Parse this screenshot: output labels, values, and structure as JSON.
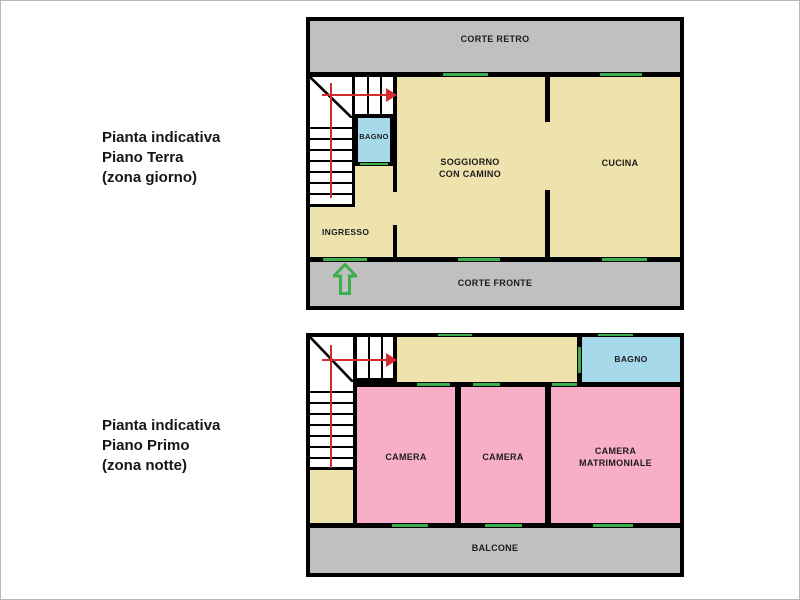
{
  "captions": {
    "ground": {
      "l1": "Pianta indicativa",
      "l2": "Piano Terra",
      "l3": "(zona giorno)"
    },
    "first": {
      "l1": "Pianta indicativa",
      "l2": "Piano Primo",
      "l3": "(zona notte)"
    }
  },
  "ground": {
    "corte_retro": "CORTE RETRO",
    "bagno": "BAGNO",
    "soggiorno1": "SOGGIORNO",
    "soggiorno2": "CON CAMINO",
    "cucina": "CUCINA",
    "ingresso": "INGRESSO",
    "corte_fronte": "CORTE FRONTE"
  },
  "first": {
    "bagno": "BAGNO",
    "camera1": "CAMERA",
    "camera2": "CAMERA",
    "matrimoniale1": "CAMERA",
    "matrimoniale2": "MATRIMONIALE",
    "balcone": "BALCONE"
  },
  "icons": {
    "entrance_arrow": "green-up-arrow-outline",
    "stairs_arrow_ground": "red-right-arrow",
    "stairs_arrow_first": "red-right-arrow"
  },
  "colors": {
    "wall": "#000000",
    "room_beige": "#EEE3AC",
    "courtyard_gray": "#C0C0C0",
    "bath_blue": "#A6D9EA",
    "bedroom_pink": "#F8AEC7",
    "opening_green": "#3CAF4B",
    "stairs_red": "#D22D2D"
  }
}
